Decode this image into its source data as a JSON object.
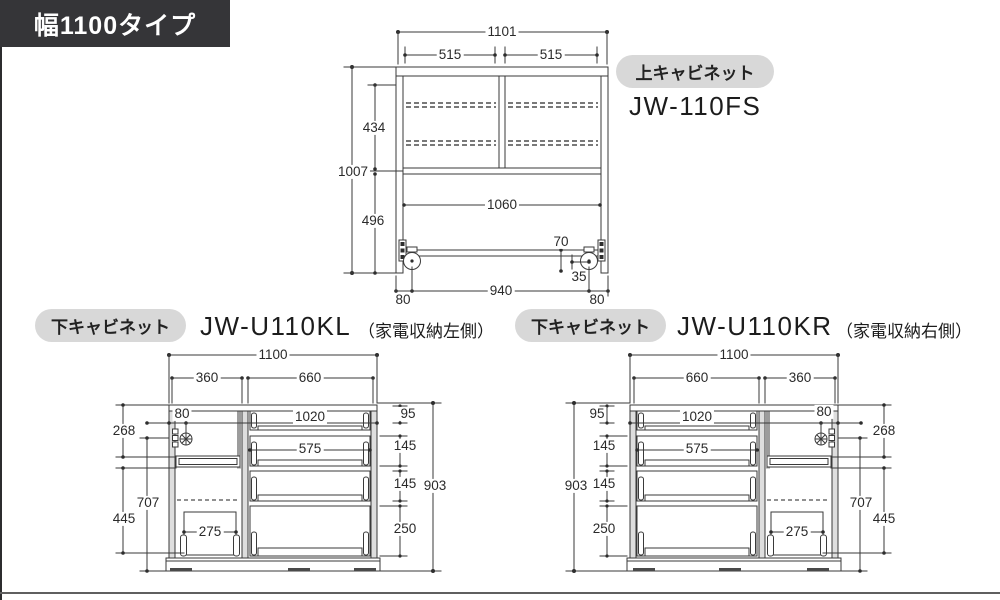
{
  "header": {
    "title": "幅1100タイプ"
  },
  "colors": {
    "title_badge_bg": "#353538",
    "title_badge_text": "#ffffff",
    "label_pill_bg": "#d8d8d8",
    "line": "#3a3a3a"
  },
  "upper_cabinet": {
    "badge": "上キャビネット",
    "model": "JW-110FS",
    "dims": {
      "total_width": "1101",
      "left_door_width": "515",
      "right_door_width": "515",
      "total_height": "1007",
      "upper_inner_height": "434",
      "lower_inner_height": "496",
      "inner_width": "1060",
      "caster_height": "70",
      "caster_inset": "35",
      "base_left_offset": "80",
      "caster_span": "940",
      "base_right_offset": "80"
    }
  },
  "lower_left_cabinet": {
    "badge": "下キャビネット",
    "model": "JW-U110KL",
    "note": "（家電収納左側）",
    "dims": {
      "total_width": "1100",
      "appliance_section_width": "360",
      "drawer_section_width": "660",
      "knob_offset": "80",
      "top_drawer_inner_width": "1020",
      "drawer_inner_width": "575",
      "top_drawer_height": "95",
      "second_drawer_height": "145",
      "third_drawer_height": "145",
      "bottom_drawer_height": "250",
      "total_height": "903",
      "upper_door_height": "268",
      "lower_section_height": "707",
      "open_space_height": "445",
      "slide_rack_width": "275"
    }
  },
  "lower_right_cabinet": {
    "badge": "下キャビネット",
    "model": "JW-U110KR",
    "note": "（家電収納右側）",
    "dims": {
      "total_width": "1100",
      "appliance_section_width": "360",
      "drawer_section_width": "660",
      "knob_offset": "80",
      "top_drawer_inner_width": "1020",
      "drawer_inner_width": "575",
      "top_drawer_height": "95",
      "second_drawer_height": "145",
      "third_drawer_height": "145",
      "bottom_drawer_height": "250",
      "total_height": "903",
      "upper_door_height": "268",
      "lower_section_height": "707",
      "open_space_height": "445",
      "slide_rack_width": "275"
    }
  }
}
